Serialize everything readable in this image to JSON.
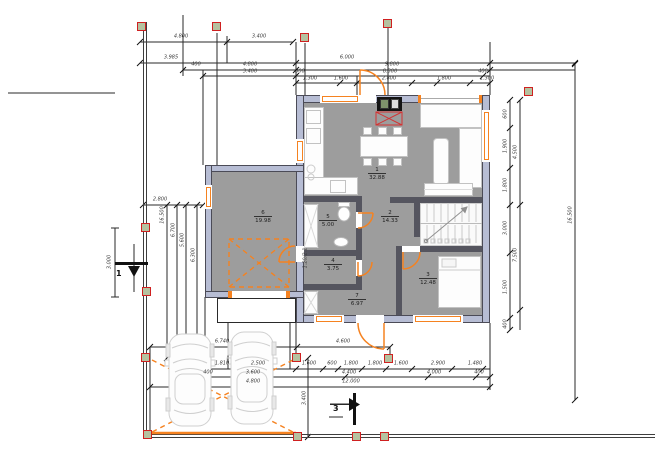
{
  "meta": {
    "drawing_type": "architectural floor plan with site dimensions"
  },
  "colors": {
    "wall": "#b7bdd4",
    "wall_edge": "#4b4b57",
    "floor": "#9d9d9d",
    "orange": "#f58220",
    "column_fill": "#b5c2a0",
    "column_border": "#cf2020",
    "hearth_red": "#d33333",
    "dim_text": "#3a3a3a"
  },
  "rooms": [
    {
      "num": "1",
      "area": "32.88"
    },
    {
      "num": "2",
      "area": "14.33"
    },
    {
      "num": "3",
      "area": "12.48"
    },
    {
      "num": "4",
      "area": "3.75"
    },
    {
      "num": "5",
      "area": "5.00"
    },
    {
      "num": "6",
      "area": "19.98"
    },
    {
      "num": "7",
      "area": "6.97"
    }
  ],
  "dims": {
    "t1a": "4.800",
    "t1b": "3.400",
    "t2a": "3.985",
    "t2b": "6.000",
    "t3a": "400",
    "t3b": "4.800",
    "t3c": "9.800",
    "t4a": "3.400",
    "t4b": "300",
    "t4c": "8.300",
    "t4d": "400",
    "t5a": "1.300",
    "t5b": "1.600",
    "t5c": "2.800",
    "t5d": "1.800",
    "t5e": "1.300",
    "l1": "2.800",
    "l2": "16.500",
    "l3": "6.700",
    "l4": "5.600",
    "l5": "6.300",
    "l6": "3.000",
    "r1": "600",
    "r2": "1.900",
    "r3": "1.800",
    "r4": "3.000",
    "r5": "1.500",
    "r6": "400",
    "r7": "4.500",
    "r8": "7.500",
    "r9": "16.500",
    "ba1": "6.740",
    "ba2": "4.600",
    "bb1": "1.810",
    "bb2": "2.500",
    "bb3": "1.600",
    "bb4": "600",
    "bb5": "1.800",
    "bb6": "1.800",
    "bb7": "1.600",
    "bb8": "2.900",
    "bb9": "1.480",
    "bc1": "400",
    "bc2": "3.600",
    "bc3": "4.400",
    "bc4": "4.000",
    "bc5": "400",
    "bd1": "4.800",
    "bd2": "12.000",
    "be1": "3.400"
  },
  "sections": {
    "one": "1",
    "three": "3"
  },
  "tags": {
    "door_size": "1.20/2.1"
  }
}
